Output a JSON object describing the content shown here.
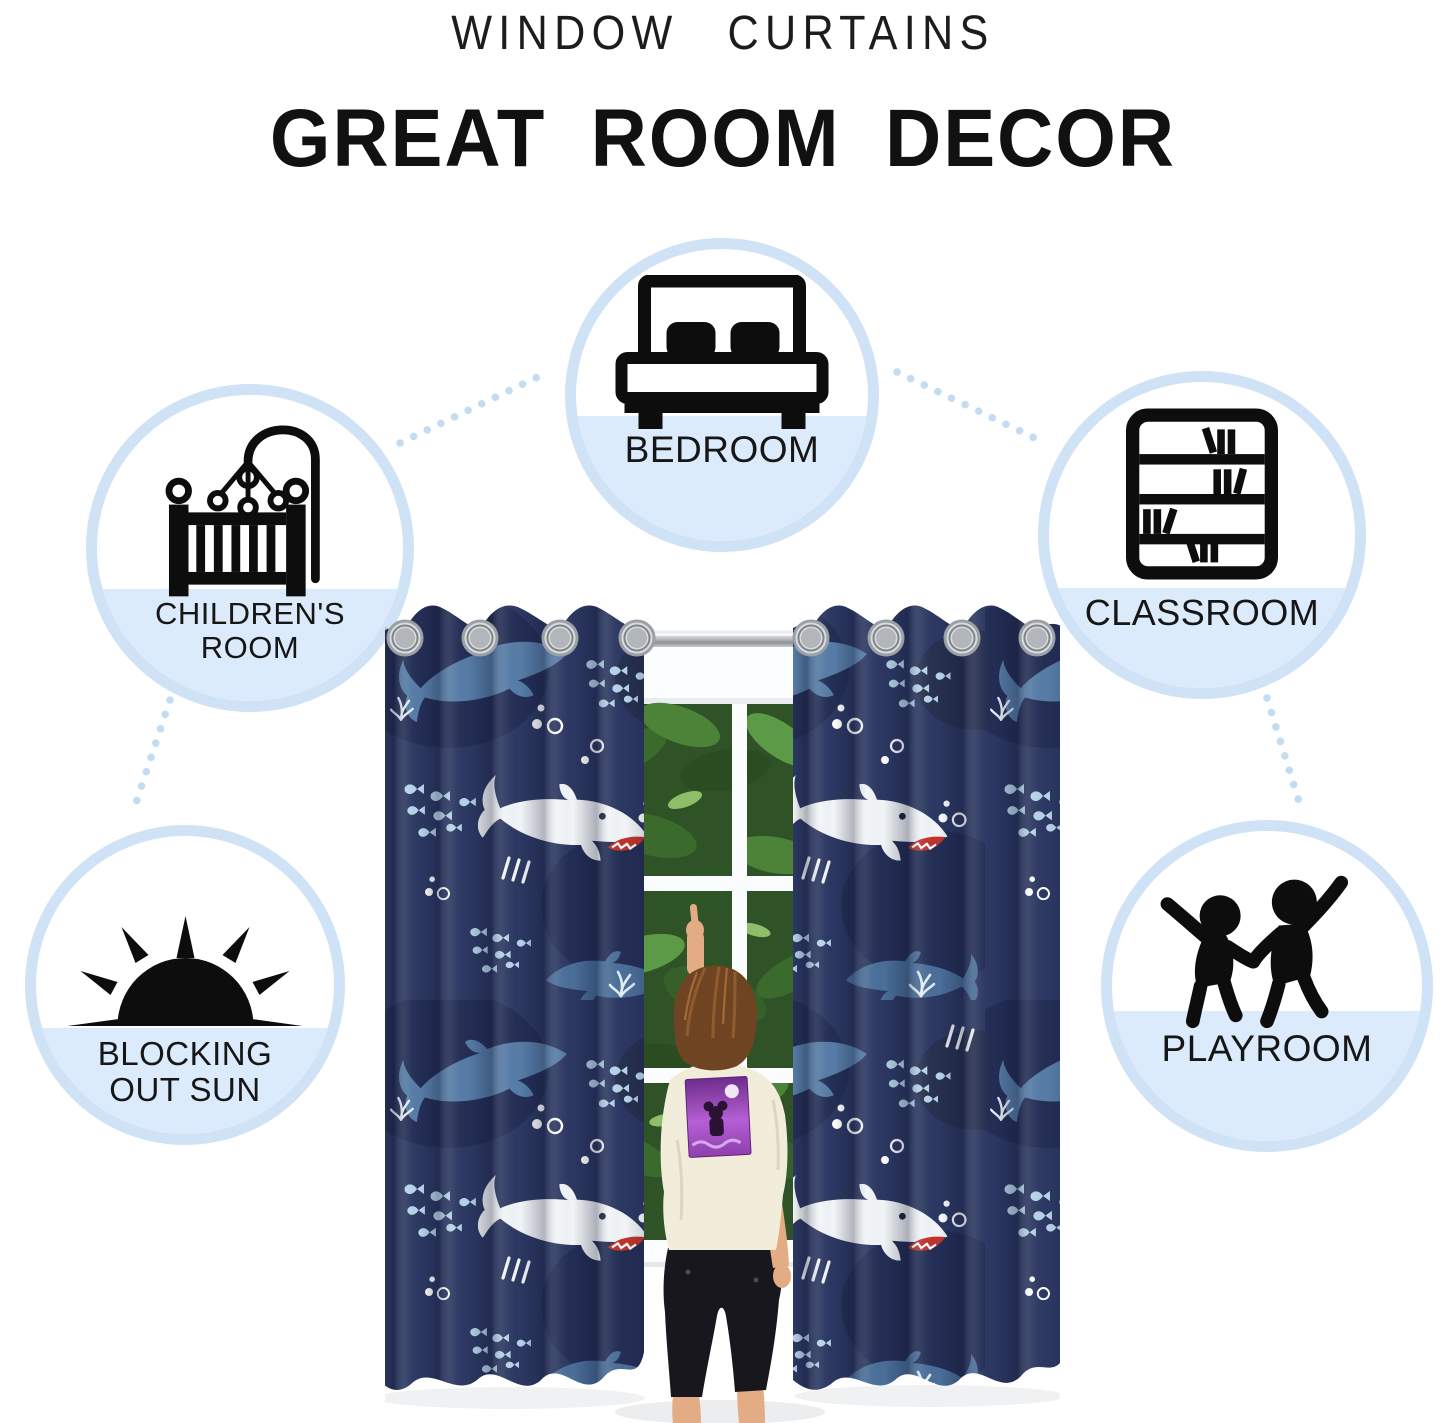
{
  "header": {
    "title": "WINDOW CURTAINS",
    "subtitle": "GREAT ROOM DECOR"
  },
  "features": [
    {
      "id": "bedroom",
      "label": "BEDROOM",
      "label2": "",
      "icon": "bed-icon"
    },
    {
      "id": "childrens-room",
      "label": "CHILDREN'S",
      "label2": "ROOM",
      "icon": "crib-icon"
    },
    {
      "id": "classroom",
      "label": "CLASSROOM",
      "label2": "",
      "icon": "bookshelf-icon"
    },
    {
      "id": "blocking-out-sun",
      "label": "BLOCKING",
      "label2": "OUT SUN",
      "icon": "sun-icon"
    },
    {
      "id": "playroom",
      "label": "PLAYROOM",
      "label2": "",
      "icon": "children-playing-icon"
    }
  ],
  "colors": {
    "circle_ring": "#cfe2f6",
    "circle_fill": "#dcebfb",
    "dotted_line": "#c3dcf2",
    "icon_black": "#0d0d0d",
    "curtain_navy": "#2c3862",
    "curtain_dark_navy": "#242e55",
    "curtain_steel_blue": "#567ca6",
    "shark_white": "#f2f5f7",
    "fish_light_blue": "#b7d3e8",
    "shark_mouth_red": "#c0332b"
  }
}
